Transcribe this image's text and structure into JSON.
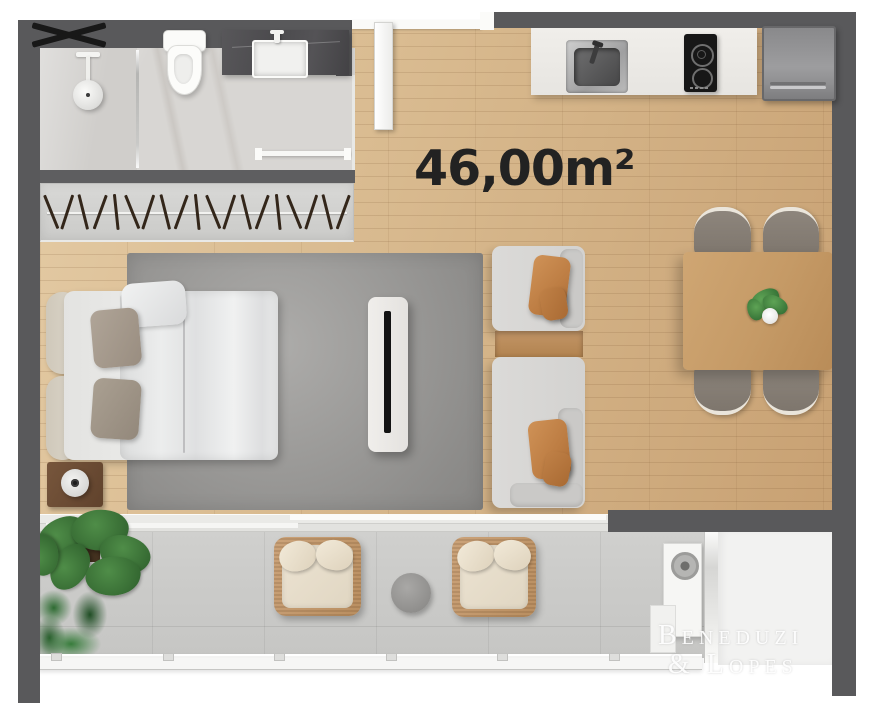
{
  "plan": {
    "area_label": "46,00m²",
    "watermark_line1": "Beneduzi",
    "watermark_line2": "& Lopes"
  },
  "decor": {
    "wardrobe_hanger_count": 19,
    "railing_post_count": 6
  },
  "colors": {
    "wall": "#59595b",
    "wood_floor": "#d6b88e",
    "rug": "#9b9a98",
    "balcony_floor": "#cbcbc9",
    "bathroom_marble": "#d8d6d3",
    "vanity_marble": "#4e4d50",
    "kitchen_counter": "#edebe7",
    "accent_pillow": "#c08349",
    "dining_table": "#c59a66",
    "plant_green": "#3a7a3c",
    "label_text": "#222222",
    "watermark_text": "#ffffff"
  }
}
